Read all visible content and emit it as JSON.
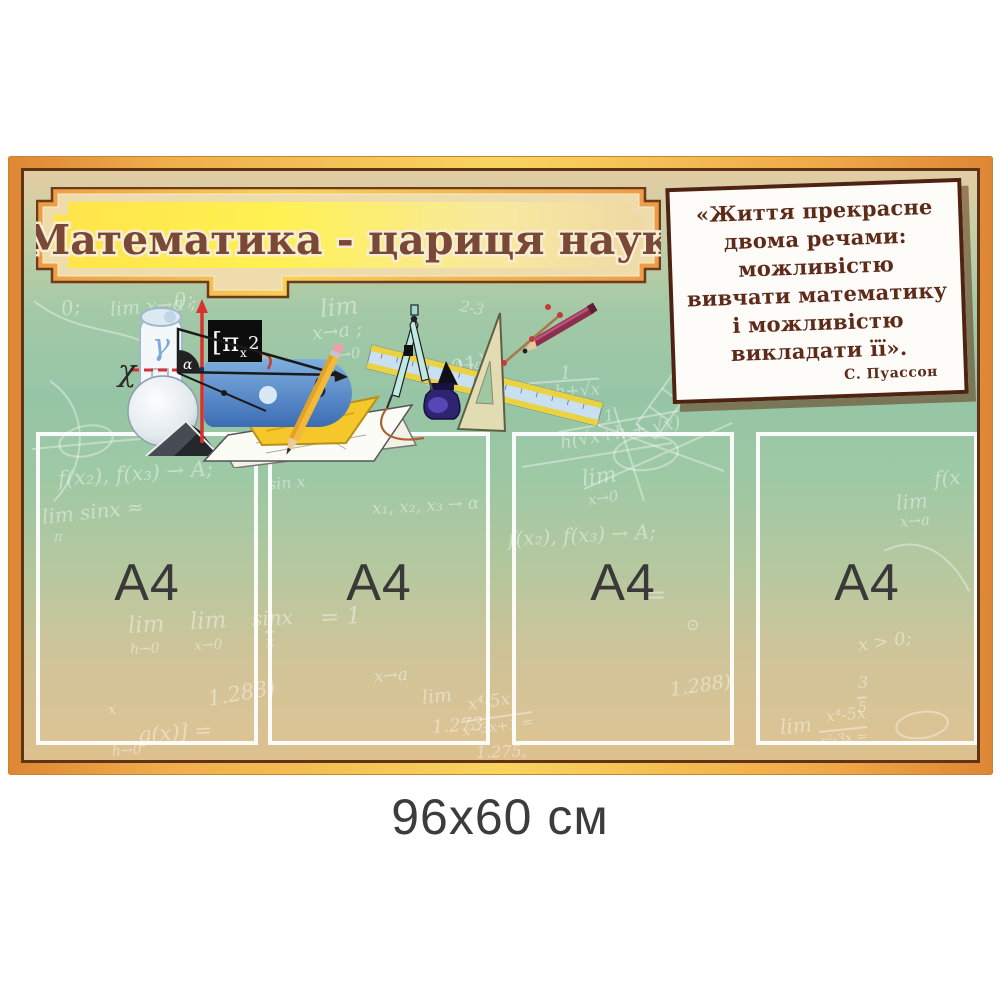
{
  "product": {
    "size_label": "96x60 см"
  },
  "banner": {
    "title": "Математика - цариця наук"
  },
  "quote": {
    "lines": [
      "«Життя прекрасне",
      "двома речами:",
      "можливістю",
      "вивчати математику",
      "і можливістю",
      "викладати її»."
    ],
    "author": "С. Пуассон"
  },
  "pockets": [
    {
      "label": "A4"
    },
    {
      "label": "A4"
    },
    {
      "label": "A4"
    },
    {
      "label": "A4"
    }
  ],
  "clipart": {
    "left_items": [
      "paper-scroll",
      "gamma-letter",
      "coordinate-axes",
      "chi-letter",
      "right-triangle",
      "alpha-letter",
      "pi-symbol-box",
      "blue-protractor",
      "beta-letter",
      "sphere",
      "prism",
      "paper-sheets",
      "yellow-set-square",
      "yellow-pencil"
    ],
    "right_items": [
      "drawing-compass",
      "blue-ruler",
      "set-square",
      "ink-bottle",
      "burgundy-pencil",
      "measuring-stick"
    ]
  },
  "colors": {
    "frame_orange": "#E8913E",
    "frame_gold": "#F8D55F",
    "frame_brown": "#5E3317",
    "board_green": "#9BC7A2",
    "board_tan": "#DEC18F",
    "banner_yellow": "#FFE94E",
    "title_brown": "#7A4837",
    "quote_brown": "#5E2B1B",
    "pocket_border": "#FFFFFF",
    "label_gray": "#3C3C3C"
  },
  "formulas": [
    {
      "t": "0;",
      "x": 37,
      "y": 128,
      "s": 20,
      "r": -10
    },
    {
      "t": "lim x→a ;",
      "x": 86,
      "y": 130,
      "s": 19,
      "r": -5
    },
    {
      "t": "0;",
      "x": 150,
      "y": 120,
      "s": 20,
      "r": -10
    },
    {
      "t": "lim",
      "x": 296,
      "y": 126,
      "s": 24,
      "r": -6
    },
    {
      "t": "x→a ;",
      "x": 288,
      "y": 154,
      "s": 19,
      "r": -6
    },
    {
      "t": "x→0",
      "x": 306,
      "y": 178,
      "s": 15,
      "r": -6
    },
    {
      "t": "2-3",
      "x": 436,
      "y": 128,
      "s": 15,
      "r": 10
    },
    {
      "t": "(.291)",
      "x": 398,
      "y": 196,
      "s": 22,
      "r": -14
    },
    {
      "t": "lim",
      "x": 700,
      "y": 126,
      "s": 20,
      "r": -10
    },
    {
      "t": "x→0",
      "x": 704,
      "y": 148,
      "s": 15,
      "r": -10
    },
    {
      "t": "0;",
      "x": 780,
      "y": 118,
      "s": 20,
      "r": -6
    },
    {
      "t": "x→a ;",
      "x": 706,
      "y": 166,
      "s": 17,
      "r": -3
    },
    {
      "t": "1",
      "x": 536,
      "y": 194,
      "s": 18,
      "r": -4
    },
    {
      "t": "√x+h+√x",
      "x": 496,
      "y": 212,
      "s": 17,
      "r": -4,
      "b": 1
    },
    {
      "t": "2√x",
      "x": 666,
      "y": 206,
      "s": 19,
      "r": -6
    },
    {
      "t": "12",
      "x": 860,
      "y": 174,
      "s": 18,
      "r": 6
    },
    {
      "t": "5 ·2",
      "x": 862,
      "y": 198,
      "s": 15,
      "r": 6,
      "b": 1
    },
    {
      "t": "A→ε",
      "x": 430,
      "y": 188,
      "s": 13,
      "r": 0
    },
    {
      "t": "1",
      "x": 580,
      "y": 238,
      "s": 16,
      "r": -10
    },
    {
      "t": "h(√x+h + √x)",
      "x": 536,
      "y": 260,
      "s": 18,
      "r": -10,
      "b": 1
    },
    {
      "t": "f(x₂), f(x₃) → A;",
      "x": 34,
      "y": 298,
      "s": 21,
      "r": -4
    },
    {
      "t": "lim sinx ≈",
      "x": 18,
      "y": 336,
      "s": 20,
      "r": -6
    },
    {
      "t": "π",
      "x": 30,
      "y": 360,
      "s": 13,
      "r": 0
    },
    {
      "t": "x₁, x₂, x₃ →  α",
      "x": 348,
      "y": 330,
      "s": 17,
      "r": -3
    },
    {
      "t": "f(x₂), f(x₃) → A;",
      "x": 484,
      "y": 358,
      "s": 20,
      "r": -3
    },
    {
      "t": "lim",
      "x": 558,
      "y": 298,
      "s": 22,
      "r": -8
    },
    {
      "t": "x→0",
      "x": 564,
      "y": 322,
      "s": 15,
      "r": -8
    },
    {
      "t": "f(x",
      "x": 910,
      "y": 298,
      "s": 20,
      "r": -5
    },
    {
      "t": "lim",
      "x": 872,
      "y": 322,
      "s": 20,
      "r": -5
    },
    {
      "t": "x→a",
      "x": 876,
      "y": 344,
      "s": 15,
      "r": -5
    },
    {
      "t": "x > 0;",
      "x": 834,
      "y": 466,
      "s": 18,
      "r": -8
    },
    {
      "t": "lim",
      "x": 104,
      "y": 444,
      "s": 23,
      "r": -3
    },
    {
      "t": "h→0",
      "x": 106,
      "y": 472,
      "s": 14,
      "r": -3
    },
    {
      "t": "lim",
      "x": 166,
      "y": 440,
      "s": 23,
      "r": -3
    },
    {
      "t": "x→0",
      "x": 170,
      "y": 468,
      "s": 14,
      "r": -3
    },
    {
      "t": "sinx",
      "x": 228,
      "y": 438,
      "s": 20,
      "r": -3
    },
    {
      "t": "x",
      "x": 242,
      "y": 460,
      "s": 15,
      "r": -3,
      "b": 1
    },
    {
      "t": "= 1",
      "x": 296,
      "y": 436,
      "s": 23,
      "r": -3
    },
    {
      "t": "x→a",
      "x": 350,
      "y": 498,
      "s": 17,
      "r": -4
    },
    {
      "t": "1.288)",
      "x": 184,
      "y": 518,
      "s": 21,
      "r": -10
    },
    {
      "t": "x",
      "x": 84,
      "y": 532,
      "s": 15,
      "r": -10
    },
    {
      "t": "g(x)] =",
      "x": 114,
      "y": 554,
      "s": 21,
      "r": -4
    },
    {
      "t": "lim",
      "x": 398,
      "y": 518,
      "s": 19,
      "r": -6
    },
    {
      "t": "x⁴-5x",
      "x": 444,
      "y": 526,
      "s": 17,
      "r": -8
    },
    {
      "t": "x²-3x+1 =",
      "x": 438,
      "y": 550,
      "s": 14,
      "r": -8,
      "b": 1
    },
    {
      "t": "1.273,",
      "x": 408,
      "y": 548,
      "s": 18,
      "r": -4
    },
    {
      "t": "1.275,",
      "x": 452,
      "y": 574,
      "s": 16,
      "r": -2
    },
    {
      "t": "=",
      "x": 622,
      "y": 412,
      "s": 24,
      "r": 0
    },
    {
      "t": "⊙",
      "x": 662,
      "y": 446,
      "s": 16,
      "r": 0
    },
    {
      "t": "1.288)",
      "x": 646,
      "y": 510,
      "s": 19,
      "r": -8
    },
    {
      "t": "3",
      "x": 834,
      "y": 504,
      "s": 16,
      "r": -4
    },
    {
      "t": "5",
      "x": 834,
      "y": 526,
      "s": 14,
      "r": -4,
      "b": 1
    },
    {
      "t": "lim",
      "x": 756,
      "y": 546,
      "s": 20,
      "r": -5
    },
    {
      "t": "x⁴-5x",
      "x": 802,
      "y": 538,
      "s": 16,
      "r": -6
    },
    {
      "t": "x²-3x =",
      "x": 796,
      "y": 560,
      "s": 13,
      "r": -6,
      "b": 1
    },
    {
      "t": "sin x",
      "x": 244,
      "y": 306,
      "s": 16,
      "r": -5
    },
    {
      "t": "h→0",
      "x": 88,
      "y": 574,
      "s": 14,
      "r": -4
    }
  ]
}
